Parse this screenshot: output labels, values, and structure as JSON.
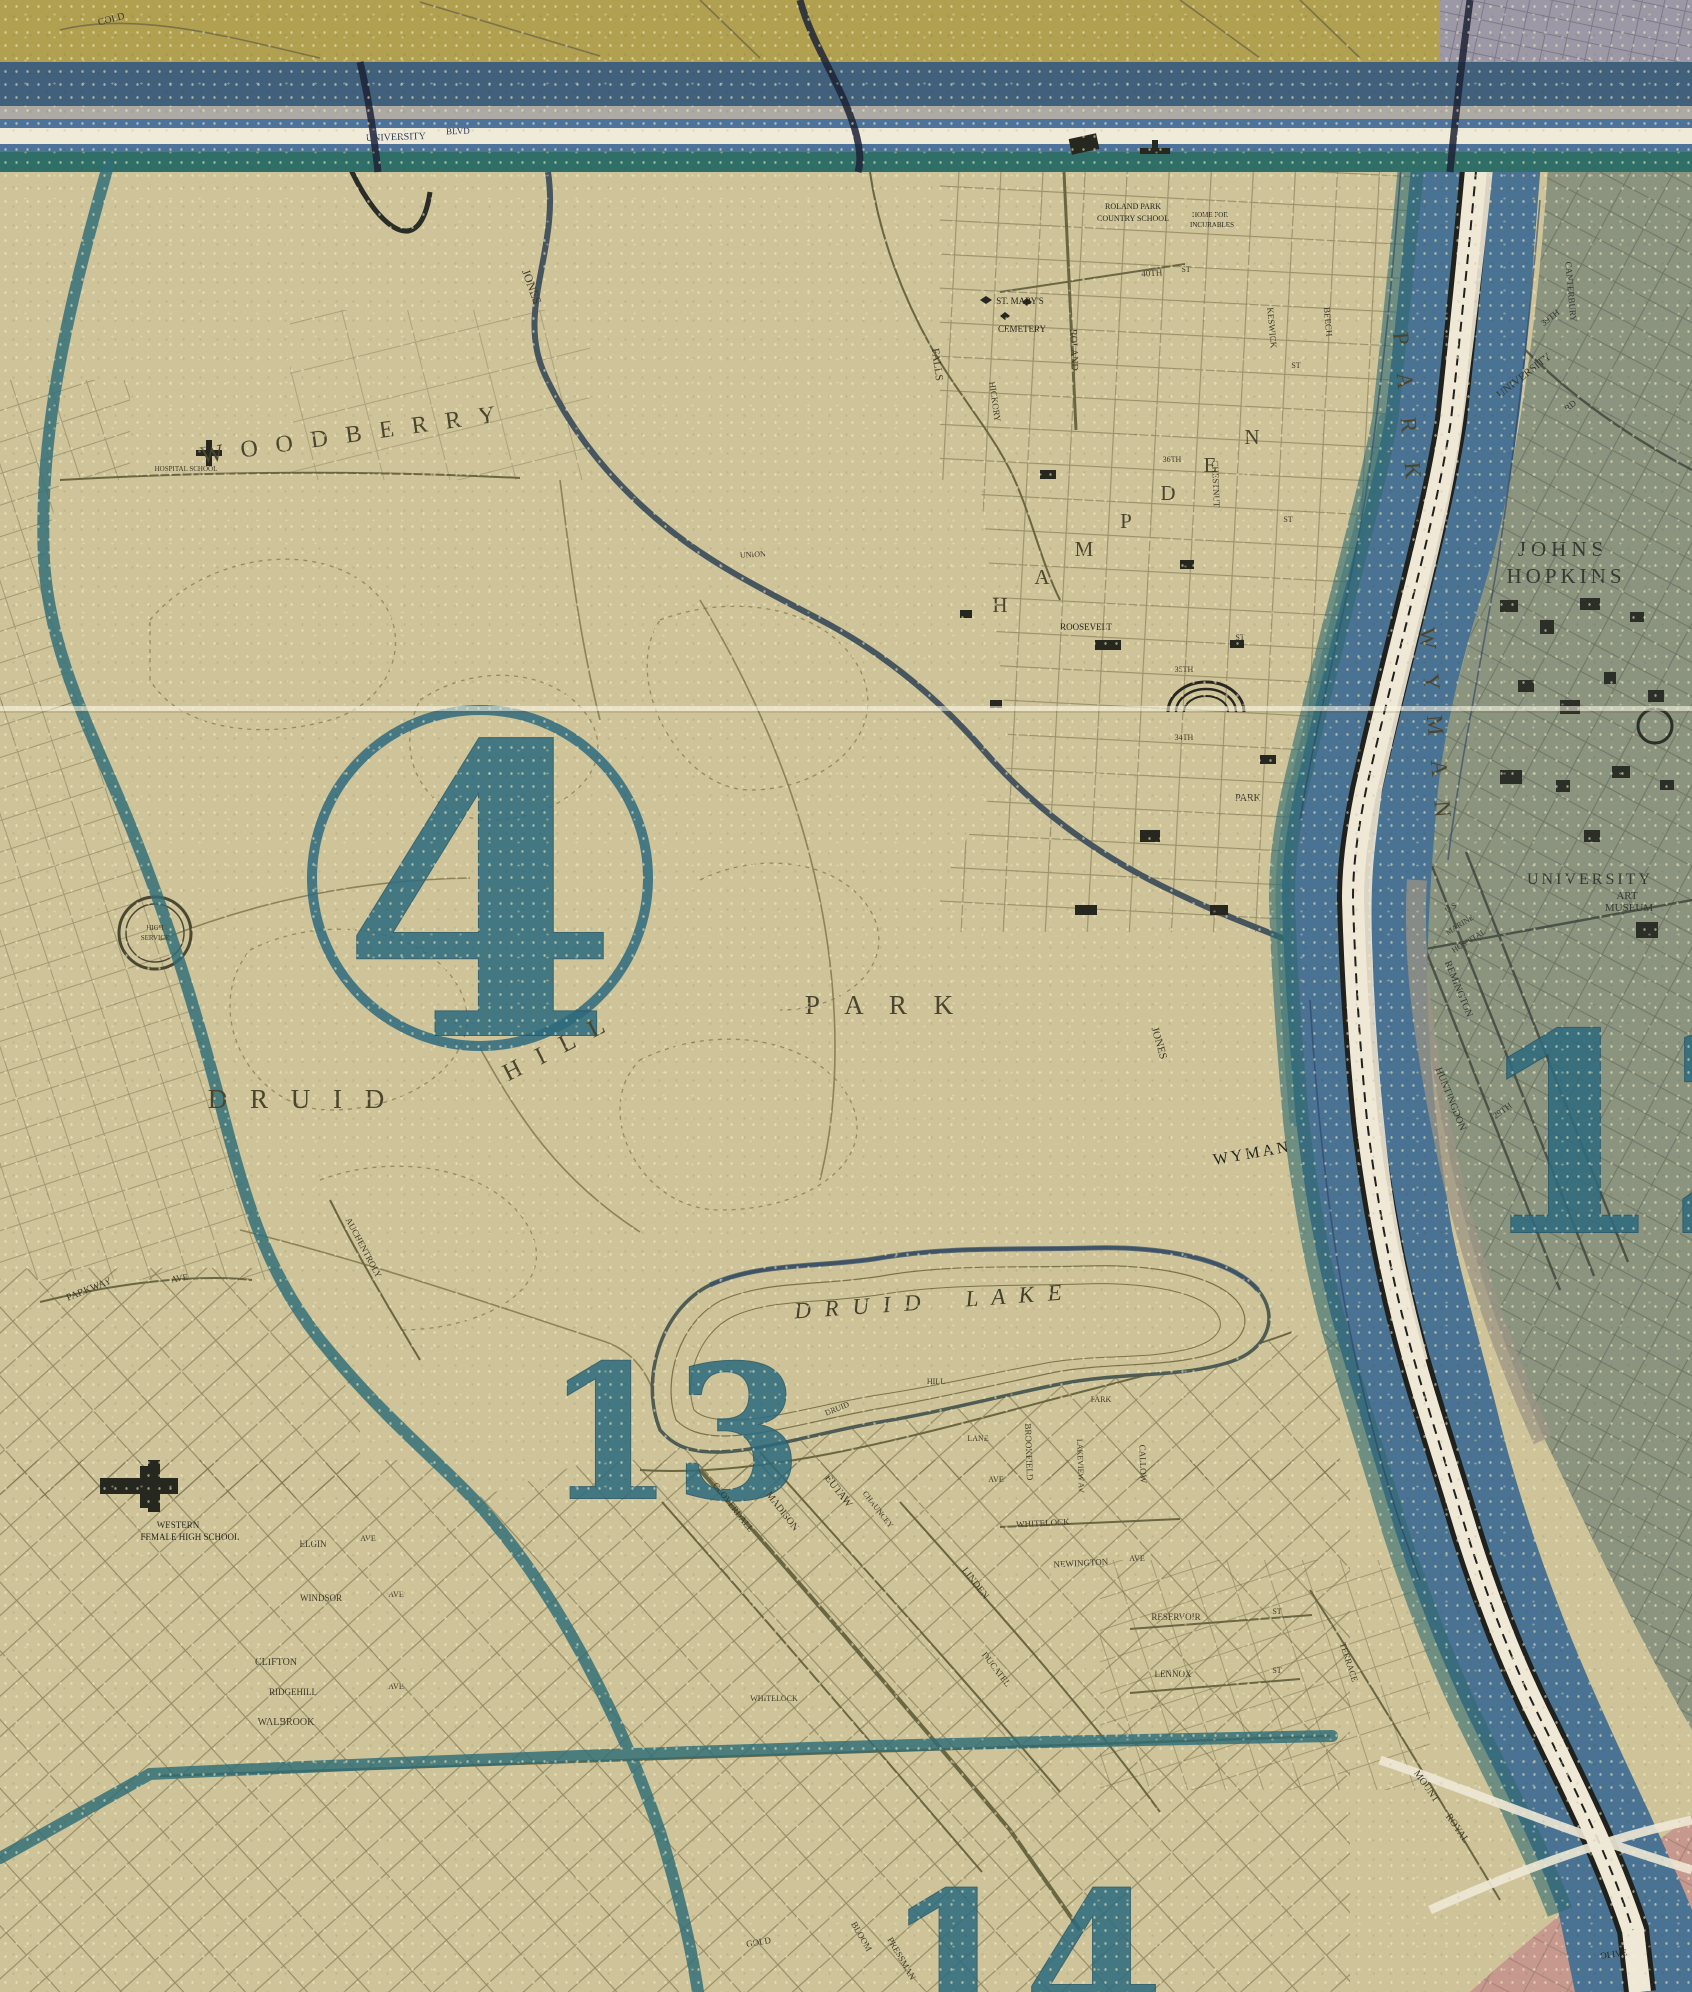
{
  "map": {
    "type": "vintage-city-district-map",
    "city_area": "Druid Hill Park / Hampden / Wyman Park",
    "palette": {
      "paper_tan": "#cec399",
      "street_ink": "#6e6845",
      "label_ink": "#3e3a28",
      "district_teal": "#2d6b7e",
      "boundary_teal": "#2f6e78",
      "band_olive": "#b1a050",
      "band_slate": "#41607b",
      "band_blue": "#4d739a",
      "band_white": "#f0ead9",
      "band_tealgreen": "#2f6f68",
      "valley_blue": "#4a7292",
      "stream_white": "#efe8d6",
      "rail_black": "#20211c",
      "zone12_gray_green": "#87917d",
      "zone_pink": "#c6968c",
      "corner_lavender": "#9d98a6"
    },
    "districts": [
      {
        "number": "4",
        "circled": true,
        "cx": 480,
        "cy": 878,
        "r": 168,
        "tx": 480,
        "ty": 1035,
        "size": 400
      },
      {
        "number": "13",
        "circled": false,
        "tx": 674,
        "ty": 1498,
        "size": 185
      },
      {
        "number": "14",
        "circled": false,
        "tx": 1024,
        "ty": 2036,
        "size": 200
      },
      {
        "number": "12",
        "circled": false,
        "tx": 1665,
        "ty": 1232,
        "size": 275
      }
    ],
    "labels": [
      {
        "t": "W O O D B E R R Y",
        "x": 352,
        "y": 442,
        "s": 24,
        "r": -8,
        "ls": 6,
        "cls": "area",
        "n": "area-label-woodberry"
      },
      {
        "t": "D R U I D",
        "x": 300,
        "y": 1108,
        "s": 27,
        "ls": 8,
        "cls": "area",
        "n": "area-label-druid"
      },
      {
        "t": "H I L L",
        "x": 560,
        "y": 1055,
        "s": 25,
        "r": -27,
        "ls": 6,
        "cls": "area",
        "n": "area-label-hill"
      },
      {
        "t": "P A R K",
        "x": 884,
        "y": 1014,
        "s": 27,
        "ls": 10,
        "cls": "area",
        "n": "area-label-park"
      },
      {
        "t": "D R U I D",
        "x": 860,
        "y": 1314,
        "s": 23,
        "r": -4,
        "ls": 4,
        "cls": "ital big",
        "n": "lake-label-druid"
      },
      {
        "t": "L A K E",
        "x": 1016,
        "y": 1303,
        "s": 23,
        "r": -4,
        "ls": 4,
        "cls": "ital big",
        "n": "lake-label-lake"
      },
      {
        "t": "JOHNS",
        "x": 1563,
        "y": 556,
        "s": 21,
        "ls": 5,
        "cls": "gray",
        "n": "area-label-johns"
      },
      {
        "t": "HOPKINS",
        "x": 1566,
        "y": 583,
        "s": 21,
        "ls": 4,
        "cls": "gray",
        "n": "area-label-hopkins"
      },
      {
        "t": "UNIVERSITY",
        "x": 1590,
        "y": 884,
        "s": 16,
        "ls": 3,
        "cls": "gray",
        "n": "area-label-university"
      },
      {
        "t": "ART",
        "x": 1627,
        "y": 899,
        "s": 11,
        "cls": "gray",
        "n": "area-label-art"
      },
      {
        "t": "MUSEUM",
        "x": 1629,
        "y": 911,
        "s": 11,
        "cls": "gray",
        "n": "area-label-museum"
      },
      {
        "t": "P A R K",
        "x": 1400,
        "y": 412,
        "s": 23,
        "r": 85,
        "ls": 12,
        "cls": "area",
        "n": "area-label-wyman-park-upper"
      },
      {
        "t": "W Y M A N",
        "x": 1428,
        "y": 728,
        "s": 23,
        "r": 85,
        "ls": 10,
        "cls": "area",
        "n": "area-label-wyman-vertical"
      },
      {
        "t": "WYMAN",
        "x": 1253,
        "y": 1158,
        "s": 16,
        "r": -10,
        "ls": 3,
        "cls": "dark",
        "n": "area-label-wyman-bend"
      },
      {
        "t": "H",
        "x": 1000,
        "y": 612,
        "s": 21,
        "cls": "area",
        "n": "area-letter-hampden-h"
      },
      {
        "t": "A",
        "x": 1042,
        "y": 584,
        "s": 21,
        "cls": "area",
        "n": "area-letter-hampden-a"
      },
      {
        "t": "M",
        "x": 1084,
        "y": 556,
        "s": 21,
        "cls": "area",
        "n": "area-letter-hampden-m"
      },
      {
        "t": "P",
        "x": 1126,
        "y": 528,
        "s": 21,
        "cls": "area",
        "n": "area-letter-hampden-p"
      },
      {
        "t": "D",
        "x": 1168,
        "y": 500,
        "s": 21,
        "cls": "area",
        "n": "area-letter-hampden-d"
      },
      {
        "t": "E",
        "x": 1210,
        "y": 472,
        "s": 21,
        "cls": "area",
        "n": "area-letter-hampden-e"
      },
      {
        "t": "N",
        "x": 1252,
        "y": 444,
        "s": 21,
        "cls": "area",
        "n": "area-letter-hampden-n"
      },
      {
        "t": "COLD",
        "x": 112,
        "y": 22,
        "s": 10,
        "r": -15,
        "n": "street-label-cold"
      },
      {
        "t": "JONES",
        "x": 528,
        "y": 288,
        "s": 12,
        "r": 70,
        "n": "street-label-jones-upper"
      },
      {
        "t": "JONES",
        "x": 1156,
        "y": 1044,
        "s": 11,
        "r": 74,
        "n": "street-label-jones-falls"
      },
      {
        "t": "FALLS",
        "x": 934,
        "y": 365,
        "s": 11,
        "r": 82,
        "n": "street-label-falls"
      },
      {
        "t": "HICKORY",
        "x": 992,
        "y": 402,
        "s": 9,
        "r": 82,
        "n": "street-label-hickory"
      },
      {
        "t": "ROLAND",
        "x": 1071,
        "y": 350,
        "s": 10,
        "r": 88,
        "n": "street-label-roland"
      },
      {
        "t": "40TH",
        "x": 1152,
        "y": 276,
        "s": 9,
        "r": -4,
        "n": "street-label-40th"
      },
      {
        "t": "ST",
        "x": 1186,
        "y": 272,
        "s": 8,
        "n": "street-label-st-1"
      },
      {
        "t": "KESWICK",
        "x": 1269,
        "y": 328,
        "s": 9,
        "r": 85,
        "n": "street-label-keswick"
      },
      {
        "t": "BEECH",
        "x": 1325,
        "y": 322,
        "s": 9,
        "r": 85,
        "n": "street-label-beech"
      },
      {
        "t": "CHESTNUT",
        "x": 1213,
        "y": 484,
        "s": 9,
        "r": 88,
        "n": "street-label-chestnut"
      },
      {
        "t": "39TH",
        "x": 1552,
        "y": 320,
        "s": 9,
        "r": -38,
        "cls": "gray",
        "n": "street-label-39th"
      },
      {
        "t": "UNIVERSITY",
        "x": 1526,
        "y": 378,
        "s": 11,
        "r": -38,
        "cls": "gray",
        "n": "street-label-university-pkwy"
      },
      {
        "t": "RD",
        "x": 1572,
        "y": 408,
        "s": 9,
        "r": -38,
        "cls": "gray",
        "n": "street-label-rd"
      },
      {
        "t": "CANTERBURY",
        "x": 1568,
        "y": 292,
        "s": 9,
        "r": 85,
        "cls": "gray",
        "n": "street-label-canterbury"
      },
      {
        "t": "36TH",
        "x": 1172,
        "y": 462,
        "s": 8,
        "n": "street-label-36th"
      },
      {
        "t": "35TH",
        "x": 1184,
        "y": 672,
        "s": 8,
        "n": "street-label-35th"
      },
      {
        "t": "34TH",
        "x": 1184,
        "y": 740,
        "s": 8,
        "n": "street-label-34th"
      },
      {
        "t": "ST",
        "x": 1296,
        "y": 368,
        "s": 8,
        "n": "street-label-st-2"
      },
      {
        "t": "ST",
        "x": 1288,
        "y": 522,
        "s": 8,
        "n": "street-label-st-3"
      },
      {
        "t": "ST",
        "x": 1240,
        "y": 640,
        "s": 8,
        "n": "street-label-st-4"
      },
      {
        "t": "UNION",
        "x": 753,
        "y": 557,
        "s": 8,
        "r": -3,
        "n": "street-label-union"
      },
      {
        "t": "ROOSEVELT",
        "x": 1086,
        "y": 630,
        "s": 9,
        "cls": "dark",
        "n": "place-label-roosevelt"
      },
      {
        "t": "PARK",
        "x": 1248,
        "y": 801,
        "s": 10,
        "n": "street-label-park-small"
      },
      {
        "t": "REMINGTON",
        "x": 1456,
        "y": 990,
        "s": 10,
        "r": 68,
        "cls": "gray",
        "n": "street-label-remington"
      },
      {
        "t": "HUNTINGDON",
        "x": 1448,
        "y": 1100,
        "s": 10,
        "r": 68,
        "cls": "gray",
        "n": "street-label-huntingdon"
      },
      {
        "t": "29TH",
        "x": 1504,
        "y": 1113,
        "s": 9,
        "r": -35,
        "cls": "gray",
        "n": "street-label-29th"
      },
      {
        "t": "PARKWAY",
        "x": 90,
        "y": 1292,
        "s": 10,
        "r": -22,
        "n": "street-label-parkway"
      },
      {
        "t": "AVE",
        "x": 180,
        "y": 1281,
        "s": 9,
        "r": -10,
        "n": "street-label-parkway-ave"
      },
      {
        "t": "AUCHENTROLY",
        "x": 361,
        "y": 1249,
        "s": 9,
        "r": 62,
        "n": "street-label-auchentroly"
      },
      {
        "t": "CLOVERDALE",
        "x": 731,
        "y": 1509,
        "s": 9,
        "r": 52,
        "n": "street-label-cloverdale"
      },
      {
        "t": "EUTAW",
        "x": 836,
        "y": 1493,
        "s": 11,
        "r": 52,
        "n": "street-label-eutaw"
      },
      {
        "t": "MADISON",
        "x": 780,
        "y": 1513,
        "s": 10,
        "r": 52,
        "n": "street-label-madison"
      },
      {
        "t": "CHAUNCEY",
        "x": 876,
        "y": 1511,
        "s": 8,
        "r": 52,
        "n": "street-label-chauncey"
      },
      {
        "t": "LINDEN",
        "x": 973,
        "y": 1585,
        "s": 10,
        "r": 52,
        "n": "street-label-linden"
      },
      {
        "t": "DUCATEL",
        "x": 994,
        "y": 1671,
        "s": 9,
        "r": 52,
        "n": "street-label-ducatel"
      },
      {
        "t": "WHITELOCK",
        "x": 1043,
        "y": 1526,
        "s": 9,
        "r": -3,
        "n": "street-label-whitelock"
      },
      {
        "t": "NEWINGTON",
        "x": 1081,
        "y": 1566,
        "s": 9,
        "r": -3,
        "n": "street-label-newington"
      },
      {
        "t": "AVE",
        "x": 1137,
        "y": 1561,
        "s": 8,
        "n": "street-label-newington-ave"
      },
      {
        "t": "BROOKFIELD",
        "x": 1026,
        "y": 1452,
        "s": 9,
        "r": 88,
        "n": "street-label-brookfield"
      },
      {
        "t": "CALLOW",
        "x": 1140,
        "y": 1464,
        "s": 9,
        "r": 88,
        "n": "street-label-callow"
      },
      {
        "t": "LAKEVIEW AV",
        "x": 1078,
        "y": 1466,
        "s": 8,
        "r": 88,
        "n": "street-label-lakeview"
      },
      {
        "t": "LANE",
        "x": 978,
        "y": 1441,
        "s": 8,
        "n": "street-label-lane"
      },
      {
        "t": "AVE",
        "x": 996,
        "y": 1482,
        "s": 8,
        "n": "street-label-lane-ave"
      },
      {
        "t": "DRUID",
        "x": 838,
        "y": 1411,
        "s": 8,
        "r": -22,
        "n": "street-label-druid-hill-ave"
      },
      {
        "t": "HILL",
        "x": 936,
        "y": 1384,
        "s": 8,
        "n": "street-label-hill-small"
      },
      {
        "t": "PARK",
        "x": 1101,
        "y": 1402,
        "s": 8,
        "n": "street-label-park-tiny"
      },
      {
        "t": "RESERVOIR",
        "x": 1176,
        "y": 1620,
        "s": 9,
        "n": "street-label-reservoir"
      },
      {
        "t": "ST",
        "x": 1277,
        "y": 1614,
        "s": 8,
        "n": "street-label-reservoir-st"
      },
      {
        "t": "LENNOX",
        "x": 1173,
        "y": 1677,
        "s": 9,
        "n": "street-label-lennox"
      },
      {
        "t": "ST",
        "x": 1277,
        "y": 1673,
        "s": 8,
        "n": "street-label-lennox-st"
      },
      {
        "t": "TERRACE",
        "x": 1346,
        "y": 1663,
        "s": 9,
        "r": 72,
        "n": "street-label-terrace"
      },
      {
        "t": "MOUNT",
        "x": 1424,
        "y": 1788,
        "s": 10,
        "r": 55,
        "n": "street-label-mount"
      },
      {
        "t": "ROYAL",
        "x": 1455,
        "y": 1830,
        "s": 10,
        "r": 55,
        "n": "street-label-royal"
      },
      {
        "t": "ELGIN",
        "x": 313,
        "y": 1547,
        "s": 9,
        "n": "street-label-elgin"
      },
      {
        "t": "AVE",
        "x": 368,
        "y": 1541,
        "s": 8,
        "n": "street-label-elgin-ave"
      },
      {
        "t": "WINDSOR",
        "x": 321,
        "y": 1601,
        "s": 9,
        "n": "street-label-windsor"
      },
      {
        "t": "AVE",
        "x": 396,
        "y": 1597,
        "s": 8,
        "n": "street-label-windsor-ave"
      },
      {
        "t": "CLIFTON",
        "x": 276,
        "y": 1665,
        "s": 10,
        "n": "street-label-clifton"
      },
      {
        "t": "RIDGEHILL",
        "x": 293,
        "y": 1695,
        "s": 9,
        "n": "street-label-ridgehill"
      },
      {
        "t": "AVE",
        "x": 396,
        "y": 1689,
        "s": 8,
        "n": "street-label-ridgehill-ave"
      },
      {
        "t": "WALBROOK",
        "x": 286,
        "y": 1725,
        "s": 10,
        "n": "street-label-walbrook"
      },
      {
        "t": "GOLD",
        "x": 759,
        "y": 1945,
        "s": 9,
        "r": -10,
        "n": "street-label-gold"
      },
      {
        "t": "BLOOM",
        "x": 859,
        "y": 1938,
        "s": 9,
        "r": 60,
        "n": "street-label-bloom"
      },
      {
        "t": "PRESSMAN",
        "x": 899,
        "y": 1960,
        "s": 9,
        "r": 60,
        "n": "street-label-pressman"
      },
      {
        "t": "WHITELOCK",
        "x": 774,
        "y": 1701,
        "s": 8,
        "n": "street-label-whitelock-2"
      },
      {
        "t": "UNIVERSITY",
        "x": 396,
        "y": 140,
        "s": 10,
        "r": -2,
        "cls": "navy",
        "n": "street-label-university-blvd-1"
      },
      {
        "t": "BLVD",
        "x": 458,
        "y": 134,
        "s": 9,
        "r": -2,
        "cls": "navy",
        "n": "street-label-university-blvd-2"
      },
      {
        "t": "HOSPITAL  SCHOOL",
        "x": 186,
        "y": 471,
        "s": 7,
        "n": "place-label-hospital-school"
      },
      {
        "t": "ROLAND PARK",
        "x": 1133,
        "y": 209,
        "s": 8,
        "cls": "dark",
        "n": "place-label-roland-park-school-1"
      },
      {
        "t": "COUNTRY SCHOOL",
        "x": 1133,
        "y": 221,
        "s": 8,
        "cls": "dark",
        "n": "place-label-roland-park-school-2"
      },
      {
        "t": "HOME FOR",
        "x": 1210,
        "y": 217,
        "s": 7,
        "cls": "dark",
        "n": "place-label-home-for"
      },
      {
        "t": "INCURABLES",
        "x": 1212,
        "y": 227,
        "s": 7,
        "cls": "dark",
        "n": "place-label-incurables"
      },
      {
        "t": "ST. MARY'S",
        "x": 1020,
        "y": 304,
        "s": 9,
        "cls": "dark",
        "n": "place-label-st-marys"
      },
      {
        "t": "CEMETERY",
        "x": 1022,
        "y": 332,
        "s": 9,
        "cls": "dark",
        "n": "place-label-cemetery"
      },
      {
        "t": "WESTERN",
        "x": 178,
        "y": 1528,
        "s": 9,
        "cls": "dark",
        "n": "place-label-western"
      },
      {
        "t": "FEMALE HIGH SCHOOL",
        "x": 190,
        "y": 1540,
        "s": 9,
        "cls": "dark",
        "n": "place-label-female-high-school"
      },
      {
        "t": "U S",
        "x": 1452,
        "y": 910,
        "s": 8,
        "r": -32,
        "cls": "gray",
        "n": "place-label-us"
      },
      {
        "t": "MARINE",
        "x": 1461,
        "y": 927,
        "s": 8,
        "r": -32,
        "cls": "gray",
        "n": "place-label-marine"
      },
      {
        "t": "HOSPITAL",
        "x": 1470,
        "y": 943,
        "s": 8,
        "r": -32,
        "cls": "gray",
        "n": "place-label-hospital"
      },
      {
        "t": "HIGH",
        "x": 155,
        "y": 930,
        "s": 7,
        "n": "place-label-high-service-1"
      },
      {
        "t": "SERVICE",
        "x": 155,
        "y": 940,
        "s": 7,
        "n": "place-label-high-service-2"
      },
      {
        "t": "OLIVE",
        "x": 1614,
        "y": 1957,
        "s": 9,
        "r": -8,
        "cls": "dark",
        "n": "street-label-olive"
      }
    ]
  }
}
